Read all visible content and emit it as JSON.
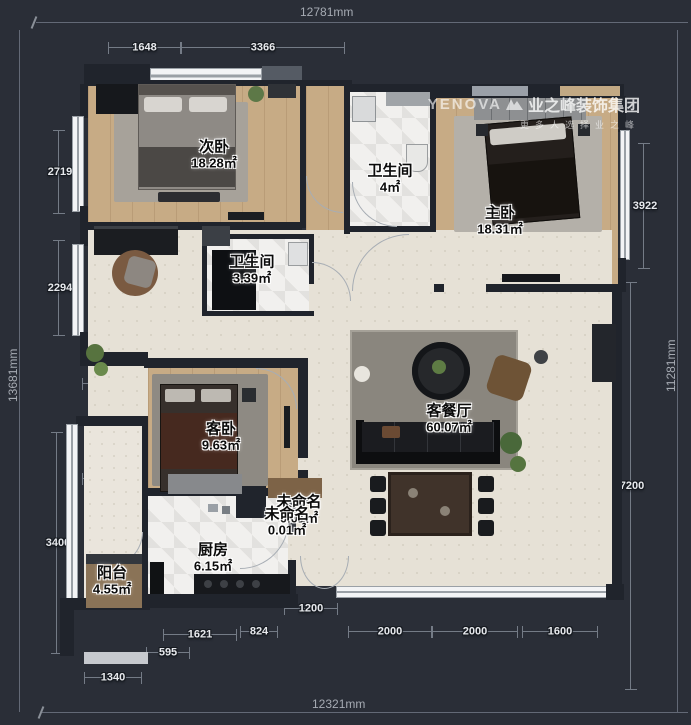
{
  "app": {
    "background": "#2a2e37"
  },
  "watermark": {
    "brand": "YENOVA",
    "company": "业之峰装饰集团",
    "tagline": "更多人选择业之峰"
  },
  "totals": {
    "top": "12781mm",
    "left": "13681mm",
    "right": "11281mm",
    "bottom": "12321mm"
  },
  "dims": {
    "top": [
      "1648",
      "3366"
    ],
    "top_right": [
      "809",
      "1447",
      "1622",
      "1902"
    ],
    "left": [
      "2719",
      "2294",
      "1363",
      "2607",
      "1340",
      "3400",
      "1340"
    ],
    "right": [
      "3922",
      "7200"
    ],
    "bottom_inner": [
      "1200"
    ],
    "bottom": [
      "595",
      "1621",
      "824",
      "2000",
      "2000",
      "1600"
    ]
  },
  "rooms": {
    "ciwo": {
      "name": "次卧",
      "area": "18.28㎡"
    },
    "bath_top": {
      "name": "卫生间",
      "area": "4㎡"
    },
    "zhuwo": {
      "name": "主卧",
      "area": "18.31㎡"
    },
    "bath_mid": {
      "name": "卫生间",
      "area": "3.39㎡"
    },
    "kewo": {
      "name": "客卧",
      "area": "9.63㎡"
    },
    "kecanting": {
      "name": "客餐厅",
      "area": "60.07㎡"
    },
    "unnamed1": {
      "name": "未命名",
      "area": "0.01㎡"
    },
    "unnamed2": {
      "name": "未命名",
      "area": "0.01㎡"
    },
    "chufang": {
      "name": "厨房",
      "area": "6.15㎡"
    },
    "yangtai": {
      "name": "阳台",
      "area": "4.55㎡"
    }
  },
  "colors": {
    "wood_floor": "#c7ab85",
    "tile_floor": "#e6e1d6",
    "bath_floor": "#f1f0ee",
    "wall": "#20242c",
    "background": "#2a2e37"
  }
}
